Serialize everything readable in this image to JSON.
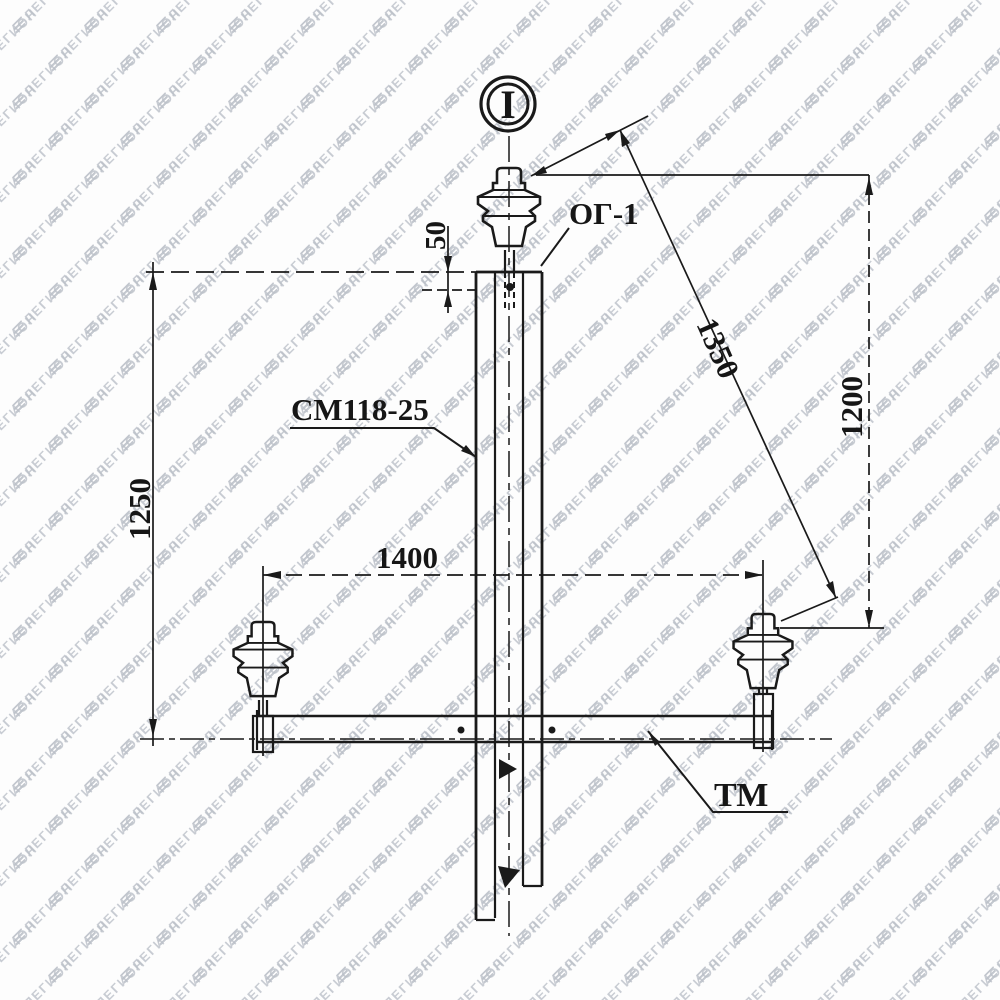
{
  "watermark": {
    "text": "ЛЕГИОН",
    "icon": "layered-flag-icon",
    "color": "#bcc1c9"
  },
  "drawing": {
    "section_marker": "I",
    "labels": {
      "hook": "ОГ-1",
      "pole": "СМ118-25",
      "crossarm": "ТМ"
    },
    "dimensions": {
      "top_offset": "50",
      "pole_top_to_crossarm": "1250",
      "diagonal_wire_distance": "1350",
      "vertical_wire_distance": "1200",
      "insulator_spacing": "1400"
    },
    "line_color": "#1a1a1a"
  }
}
